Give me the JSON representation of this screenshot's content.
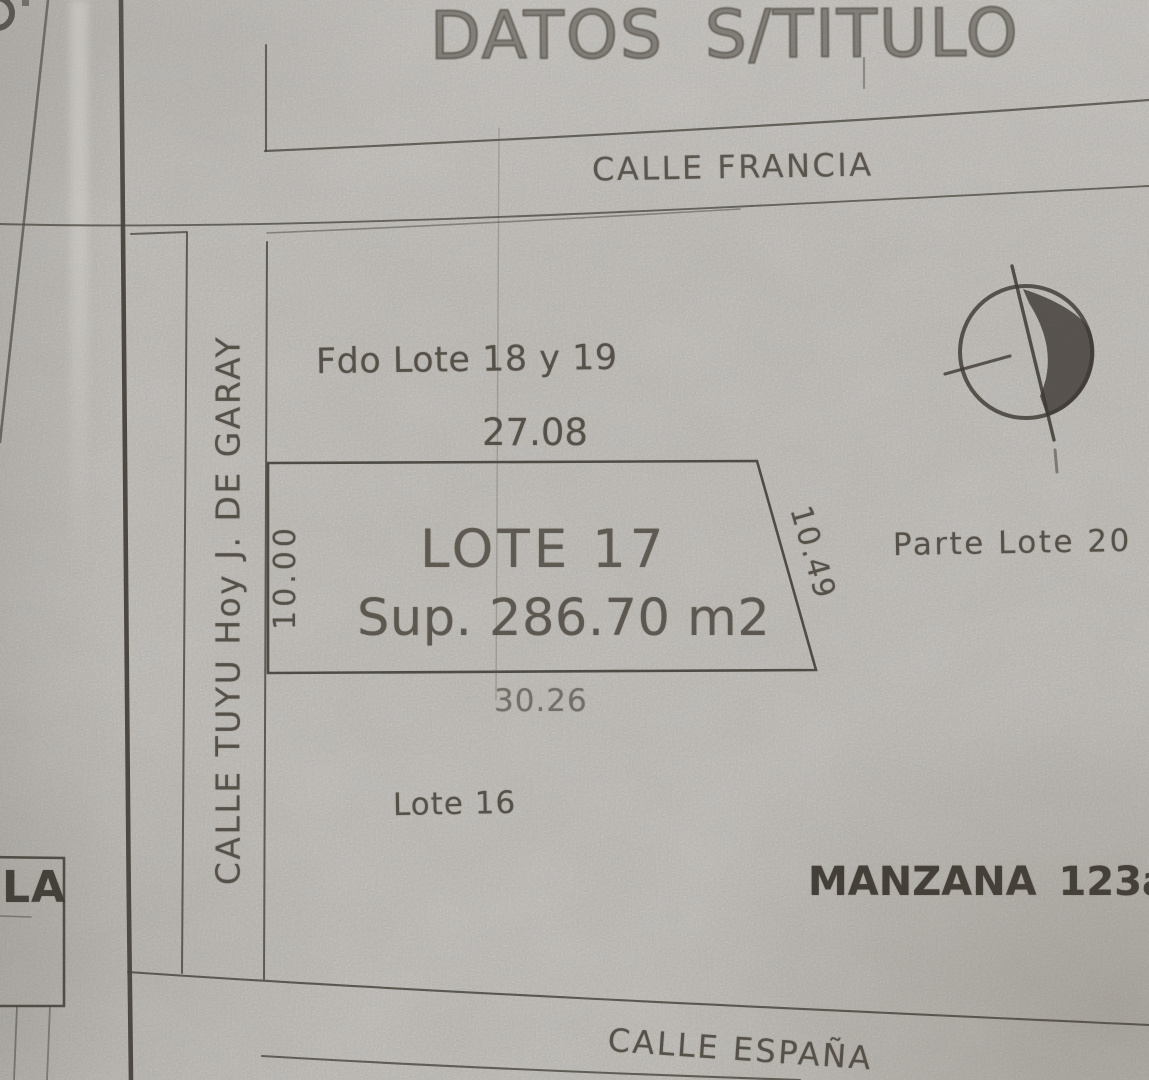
{
  "plan": {
    "title": "DATOS S/TITULO",
    "streets": {
      "north": "CALLE FRANCIA",
      "south": "CALLE ESPAÑA",
      "west": "CALLE TUYU Hoy J. DE GARAY"
    },
    "lot": {
      "label": "LOTE 17",
      "area_label": "Sup. 286.70 m2",
      "dimensions": {
        "north": "27.08",
        "east": "10.49",
        "south": "30.26",
        "west": "10.00"
      }
    },
    "neighbors": {
      "north": "Fdo Lote 18 y 19",
      "east": "Parte Lote 20",
      "south": "Lote 16"
    },
    "block_label": "MANZANA 123a",
    "edge_fragment_label": "LA",
    "icons": {
      "north_arrow": "north-arrow-icon"
    },
    "colors": {
      "paper": "#b4b1ac",
      "ink": "#4a463f",
      "ink_dark": "#39362f"
    }
  }
}
